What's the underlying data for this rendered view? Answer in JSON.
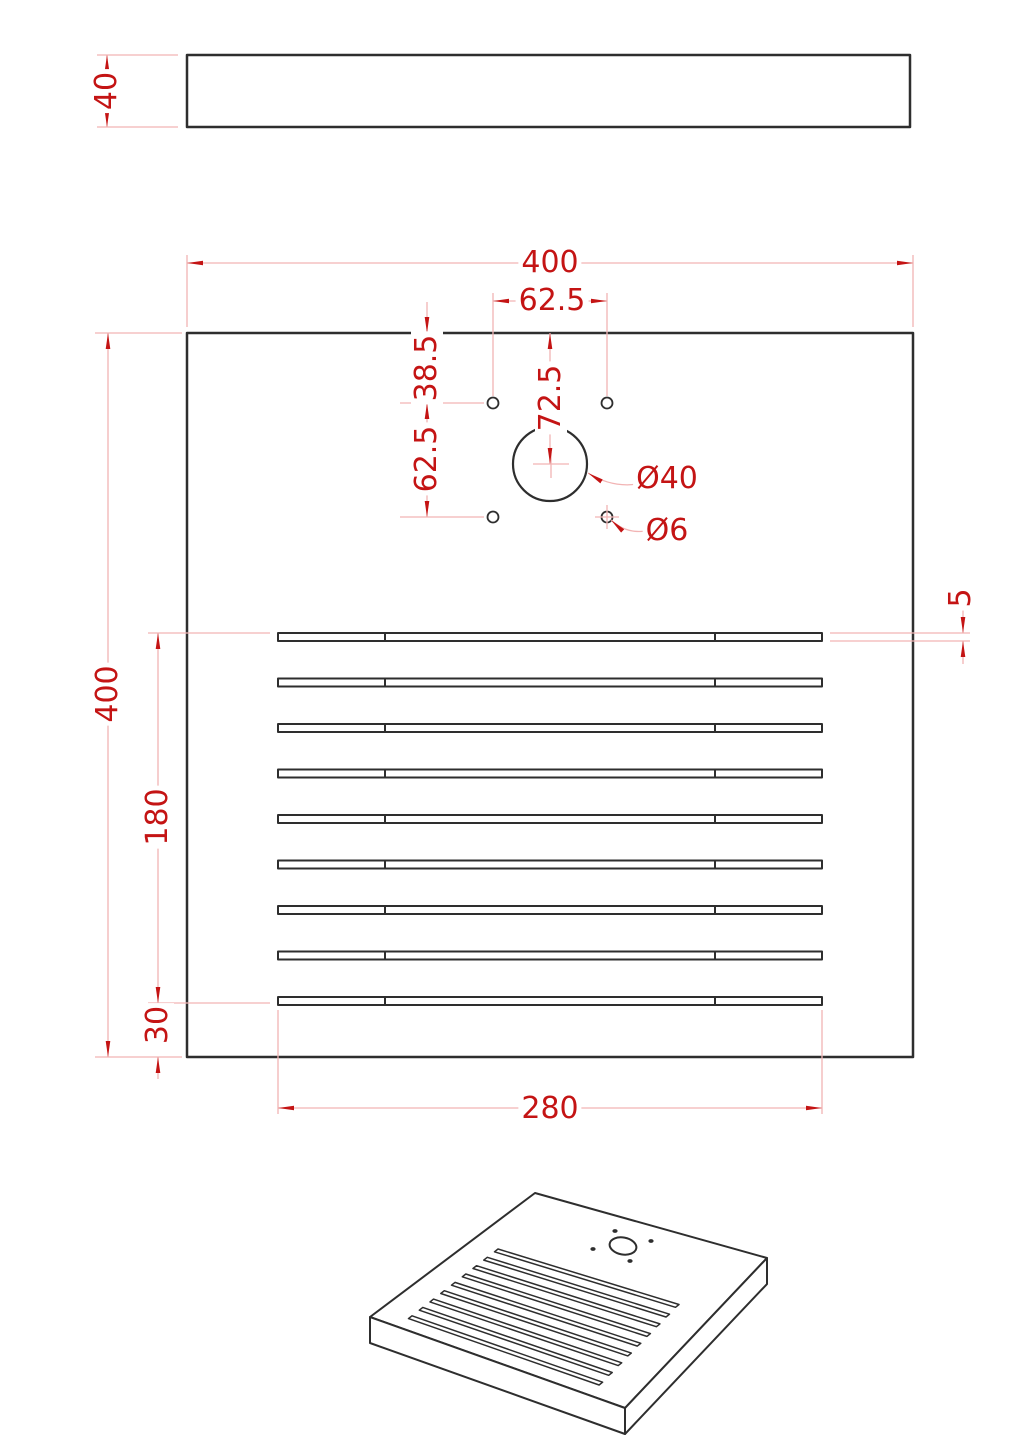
{
  "drawing": {
    "type": "technical-drawing",
    "colors": {
      "object_line": "#2e2e2e",
      "dimension_accent": "#c41414",
      "dimension_line": "#f2b4b4",
      "background": "#ffffff"
    },
    "plan_view": {
      "slot_count": 9,
      "small_hole_count": 4
    },
    "dims": {
      "side_thickness": "40",
      "plate_width": "400",
      "plate_height": "400",
      "hole_spacing_x": "62.5",
      "hole_offset_top": "38.5",
      "hole_spacing_y": "62.5",
      "center_hole_offset_top": "72.5",
      "center_hole_diameter": "Ø40",
      "small_hole_diameter": "Ø6",
      "slot_height": "5",
      "slot_group_span": "180",
      "slot_bottom_offset": "30",
      "slot_length": "280"
    }
  }
}
